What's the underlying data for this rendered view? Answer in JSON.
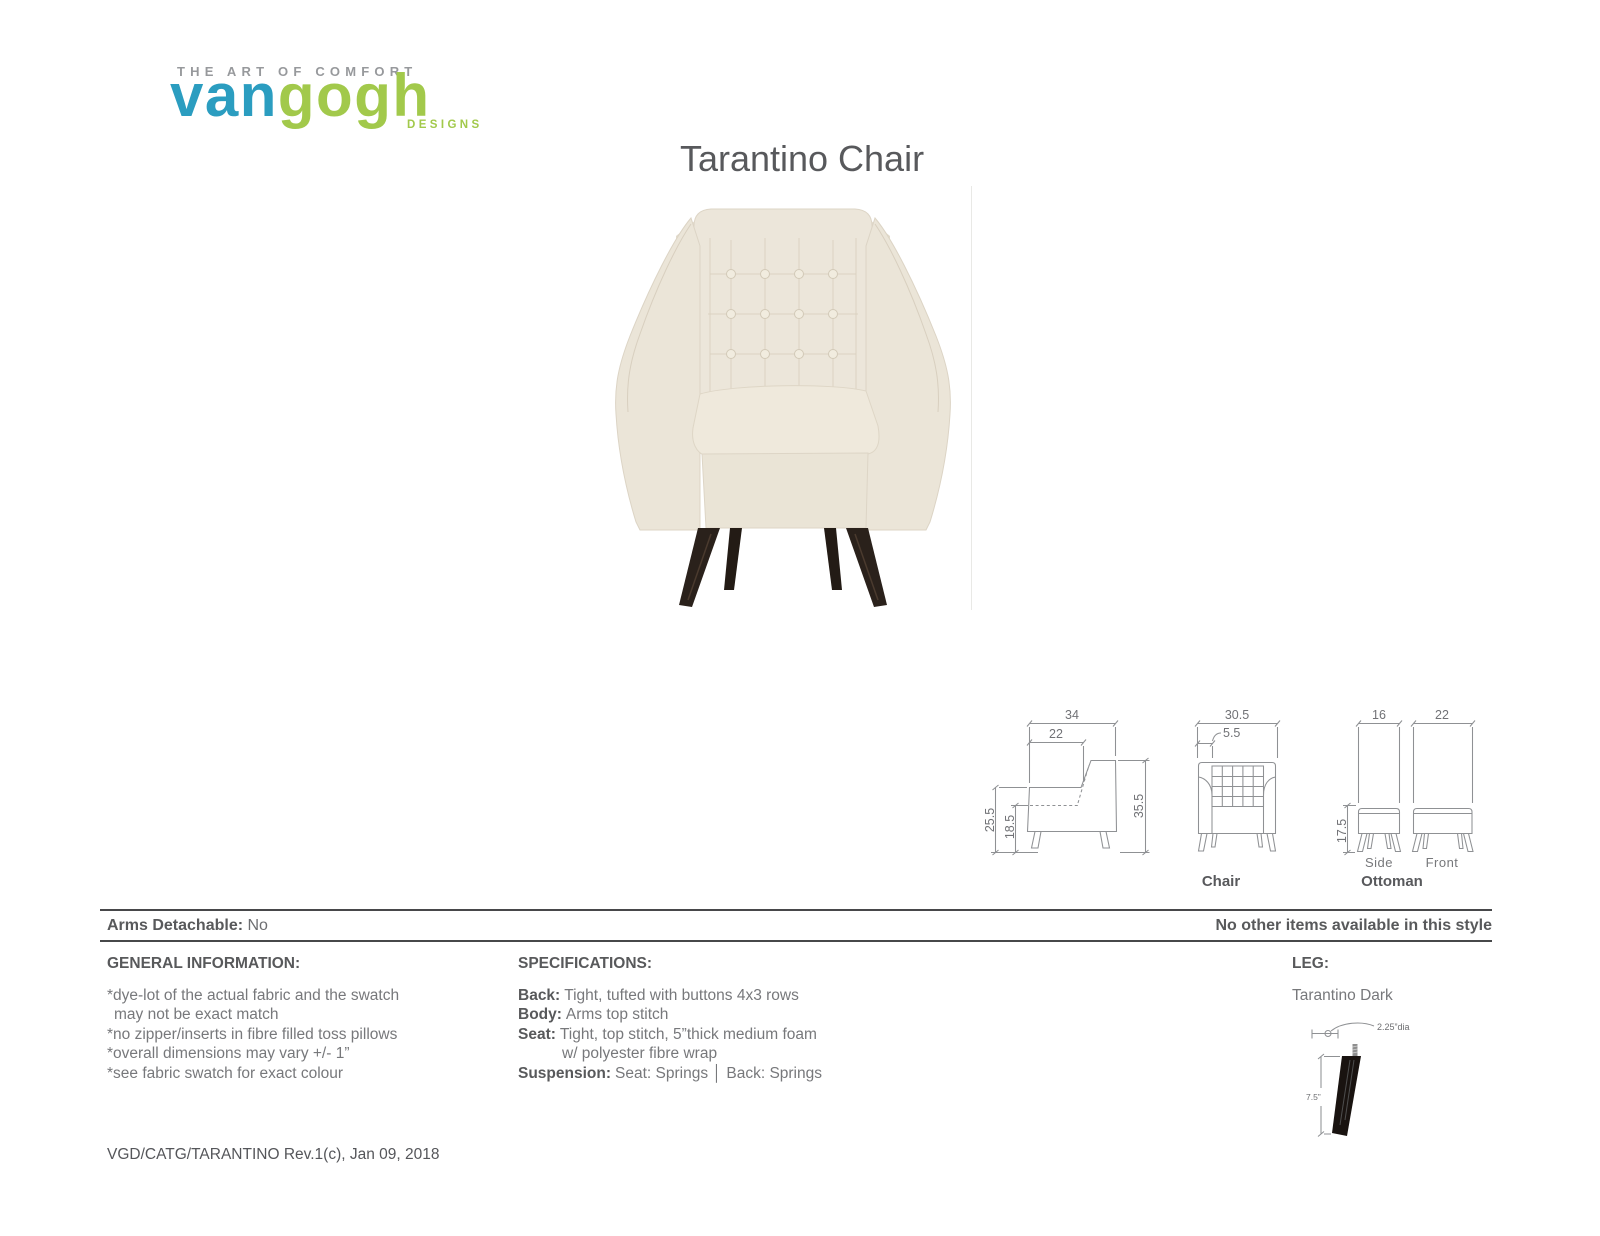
{
  "logo": {
    "tagline": "THE ART OF COMFORT",
    "word_blue": "van",
    "word_green": "gogh",
    "designs": "DESIGNS",
    "colors": {
      "blue": "#2b9dc0",
      "green": "#a2c94b",
      "gray": "#97999c"
    }
  },
  "title": "Tarantino Chair",
  "diagrams": {
    "chair_label": "Chair",
    "ottoman_label": "Ottoman",
    "side_label": "Side",
    "front_label": "Front",
    "chair_side": {
      "total_depth": "34",
      "seat_depth": "22",
      "arm_height": "25.5",
      "seat_height": "18.5",
      "total_height": "35.5"
    },
    "chair_front": {
      "total_width": "30.5",
      "arm_width": "5.5"
    },
    "ottoman": {
      "side_depth": "16",
      "front_width": "22",
      "height": "17.5"
    }
  },
  "info_bar": {
    "arms_detachable_label": "Arms Detachable:",
    "arms_detachable_value": "No",
    "right_note": "No other items available in this style"
  },
  "general_info": {
    "header": "GENERAL INFORMATION:",
    "lines": [
      "*dye-lot of the actual fabric and the swatch",
      "may not be exact match",
      "*no zipper/inserts in fibre filled toss pillows",
      "*overall dimensions may vary +/- 1”",
      "*see fabric swatch for exact colour"
    ]
  },
  "specifications": {
    "header": "SPECIFICATIONS:",
    "rows": [
      {
        "label": "Back:",
        "value": "Tight, tufted with buttons 4x3 rows"
      },
      {
        "label": "Body:",
        "value": "Arms top stitch"
      },
      {
        "label": "Seat:",
        "value": "Tight, top stitch, 5”thick medium foam"
      },
      {
        "label": "",
        "value": "w/ polyester fibre wrap"
      },
      {
        "label": "Suspension:",
        "value": "Seat: Springs │ Back: Springs"
      }
    ]
  },
  "leg": {
    "header": "LEG:",
    "name": "Tarantino Dark",
    "diameter": "2.25”dia",
    "height": "7.5”"
  },
  "footer": "VGD/CATG/TARANTINO Rev.1(c), Jan 09, 2018"
}
